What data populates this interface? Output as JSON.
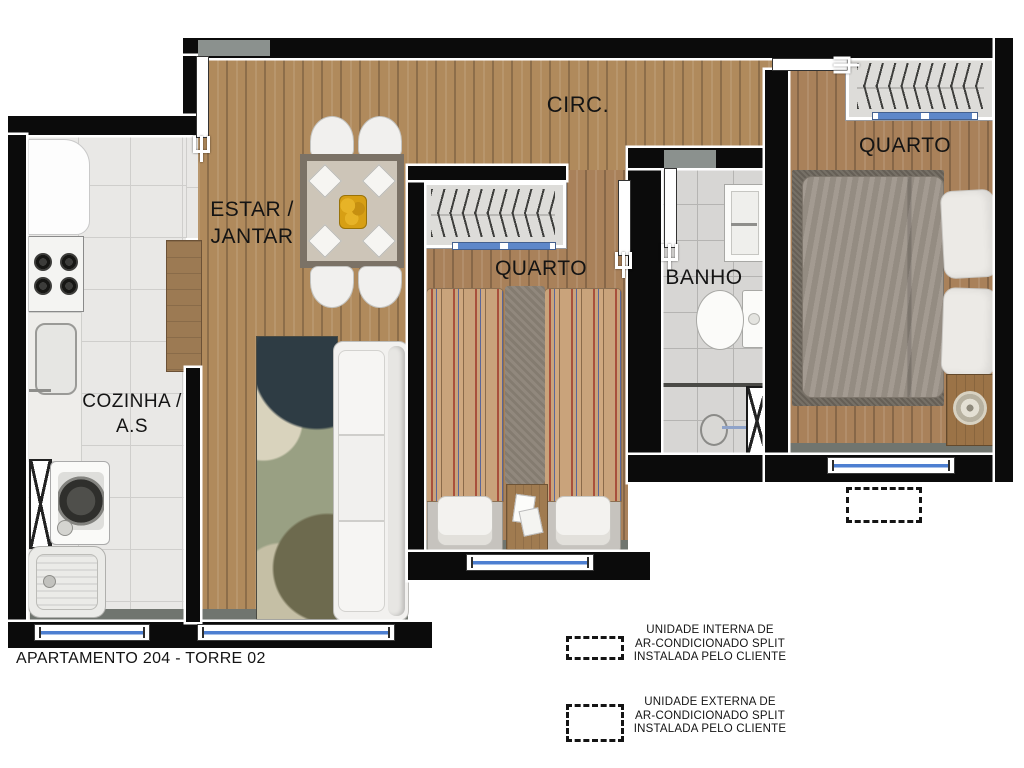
{
  "title": "APARTAMENTO 204 - TORRE 02",
  "rooms": {
    "circ": {
      "label": "CIRC."
    },
    "estar_jantar": {
      "line1": "ESTAR /",
      "line2": "JANTAR"
    },
    "cozinha": {
      "line1": "COZINHA /",
      "line2": "A.S"
    },
    "quarto_meio": {
      "label": "QUARTO"
    },
    "banho": {
      "label": "BANHO"
    },
    "quarto_direita": {
      "label": "QUARTO"
    }
  },
  "legend": {
    "interna": {
      "symbol": "dashed-box",
      "lines": [
        "UNIDADE INTERNA DE",
        "AR-CONDICIONADO SPLIT",
        "INSTALADA PELO CLIENTE"
      ]
    },
    "externa": {
      "symbol": "dashed-box",
      "lines": [
        "UNIDADE EXTERNA DE",
        "AR-CONDICIONADO SPLIT",
        "INSTALADA PELO CLIENTE"
      ]
    }
  },
  "colors": {
    "wall": "#0b0b0b",
    "wood_floor": "#b08a5c",
    "wood_floor_dark": "#a9815a",
    "kitchen_tile": "#e9e8e6",
    "bath_tile": "#d7d6d4",
    "window_glass": "#4d7fd1",
    "wardrobe_door_strip": "#5d87c9",
    "counter_wood": "#9c7a53",
    "bedspread_stripe": "#c9a37b",
    "rug_dark": "#6e675d",
    "text": "#141414"
  }
}
